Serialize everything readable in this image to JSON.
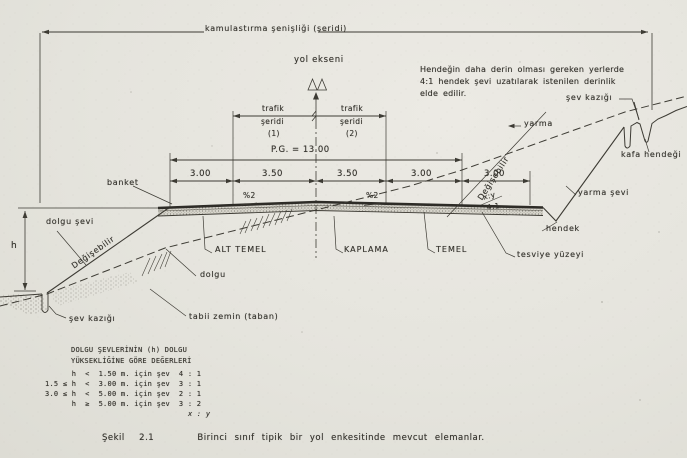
{
  "header": {
    "expropriation_width_label": "kamulastırma şenişliği (şeridi)",
    "road_axis_label": "yol ekseni"
  },
  "lanes": {
    "lane1": [
      "trafik",
      "şeridi",
      "(1)"
    ],
    "lane2": [
      "trafik",
      "şeridi",
      "(2)"
    ]
  },
  "platform": {
    "pg_label": "P.G. = 13.00",
    "segments": [
      "3.00",
      "3.50",
      "3.50",
      "3.00",
      "3.00"
    ],
    "slope_left": "%2",
    "slope_right": "%2",
    "ditch_slope_xy": "x:y",
    "ditch_slope_ratio": "4:1"
  },
  "note": {
    "line1": "Hendeğin daha derin olması  gereken yerlerde",
    "line2": "4:1 hendek şevi uzatılarak  istenilen derinlik",
    "line3": "elde  edilir."
  },
  "labels": {
    "banket": "banket",
    "dolgu_sevi": "dolgu şevi",
    "degisebilir_left": "Değişebilir",
    "degisebilir_right": "Değişebilir",
    "h": "h",
    "sev_kazigi_left": "şev kazığı",
    "tabii_zemin": "tabii zemin (taban)",
    "dolgu": "dolgu",
    "alt_temel": "ALT TEMEL",
    "kaplama": "KAPLAMA",
    "temel": "TEMEL",
    "tesviye_yuzeyi": "tesviye yüzeyi",
    "hendek": "hendek",
    "yarma": "yarma",
    "yarma_sevi": "yarma şevi",
    "sev_kazigi_right": "şev kazığı",
    "kafa_hendegi": "kafa hendeği"
  },
  "table": {
    "title_line1": "DOLGU ŞEVLERİNİN (h) DOLGU",
    "title_line2": "YÜKSEKLİĞİNE GÖRE DEĞERLERİ",
    "rows": [
      "      h  <  1.50 m. için şev  4 : 1",
      "1.5 ≤ h  <  3.00 m. için şev  3 : 1",
      "3.0 ≤ h  <  5.00 m. için şev  2 : 1",
      "      h  ≥  5.00 m. için şev  3 : 2"
    ],
    "footer": "x : y"
  },
  "caption": "Şekil  2.1      Birinci sınıf tipik bir yol enkesitinde mevcut elemanlar."
}
